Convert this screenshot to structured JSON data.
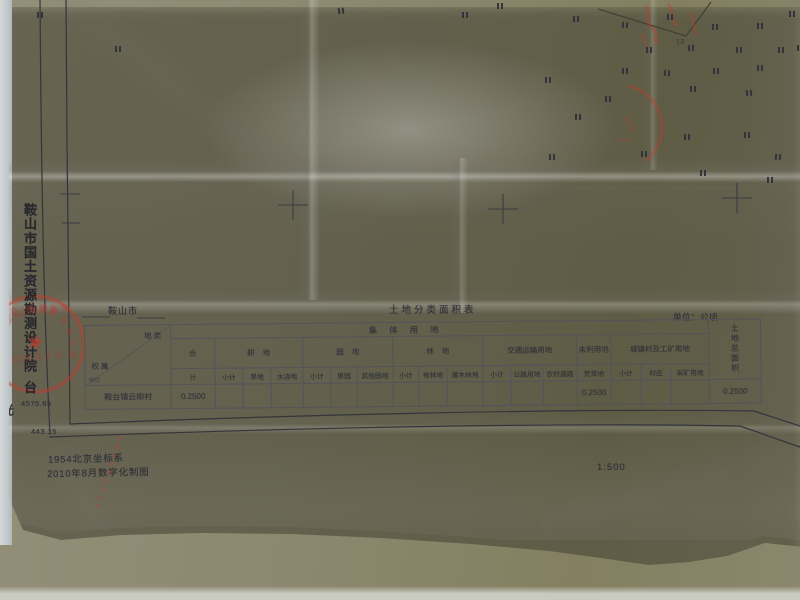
{
  "page": {
    "org_vertical_text": "鞍山市国土资源勘测设计院",
    "org_trailing_char": "台",
    "edge_clipped_char": "光",
    "grid_coord_top": "4575.65",
    "grid_coord_bottom": "443.15",
    "region_label": "鞍山市",
    "table_title": "土地分类面积表",
    "unit_note": "单位：公顷",
    "coord_system_note": "1954北京坐标系",
    "produce_note": "2010年8月数字化制图",
    "map_scale": "1:500",
    "parcel_number": "13"
  },
  "table": {
    "band_header": "集体用地",
    "corner_top": "地类",
    "corner_bottom": "权属",
    "corner_sub": "单位",
    "total_column_label": "土地总面积",
    "groups": [
      {
        "label": "合",
        "subs": [
          "计"
        ]
      },
      {
        "label": "耕地",
        "subs": [
          "小计",
          "旱地",
          "水浇地"
        ]
      },
      {
        "label": "园地",
        "subs": [
          "小计",
          "果园",
          "其他园地"
        ]
      },
      {
        "label": "林地",
        "subs": [
          "小计",
          "有林地",
          "灌木林地"
        ]
      },
      {
        "label": "交通运输用地",
        "subs": [
          "小计",
          "公路用地",
          "农村道路"
        ]
      },
      {
        "label": "未利用地",
        "subs": [
          "荒草地"
        ]
      },
      {
        "label": "城镇村及工矿用地",
        "subs": [
          "小计",
          "村庄",
          "采矿用地"
        ]
      }
    ],
    "col_widths": [
      86,
      44,
      28,
      28,
      32,
      28,
      26,
      36,
      26,
      28,
      36,
      28,
      32,
      34,
      34,
      30,
      30,
      38,
      52
    ],
    "row": {
      "owner": "鞍台镇云柳村",
      "values": [
        "0.2500",
        "",
        "",
        "",
        "",
        "",
        "",
        "",
        "",
        "",
        "",
        "",
        "",
        "0.2500",
        "",
        "",
        "",
        "0.2500"
      ]
    }
  },
  "stamp": {
    "text": "鞍山市国土资源勘测设计院",
    "star_glyph": "★",
    "color": "#bf3c30"
  },
  "map_marks": {
    "symbol": "II",
    "positions": [
      [
        37,
        12,
        0
      ],
      [
        115,
        46,
        0
      ],
      [
        338,
        8,
        -6
      ],
      [
        462,
        12,
        0
      ],
      [
        497,
        3,
        0
      ],
      [
        573,
        16,
        0
      ],
      [
        622,
        22,
        5
      ],
      [
        667,
        14,
        0
      ],
      [
        712,
        24,
        0
      ],
      [
        757,
        23,
        0
      ],
      [
        789,
        11,
        0
      ],
      [
        646,
        47,
        0
      ],
      [
        688,
        45,
        -6
      ],
      [
        736,
        47,
        0
      ],
      [
        778,
        47,
        0
      ],
      [
        797,
        45,
        0
      ],
      [
        622,
        68,
        0
      ],
      [
        664,
        70,
        6
      ],
      [
        713,
        68,
        0
      ],
      [
        757,
        65,
        0
      ],
      [
        545,
        77,
        0
      ],
      [
        690,
        86,
        0
      ],
      [
        746,
        90,
        -5
      ],
      [
        575,
        114,
        0
      ],
      [
        605,
        96,
        0
      ],
      [
        684,
        134,
        0
      ],
      [
        744,
        132,
        0
      ],
      [
        775,
        154,
        6
      ],
      [
        549,
        154,
        0
      ],
      [
        641,
        151,
        0
      ],
      [
        700,
        170,
        0
      ],
      [
        767,
        177,
        0
      ]
    ]
  },
  "colors": {
    "paper": "#e9e8e5",
    "desk": "#8e8a73",
    "ink": "#32333a",
    "stamp_red": "#bf3c30",
    "edge_strip": "#c7ccd0"
  }
}
